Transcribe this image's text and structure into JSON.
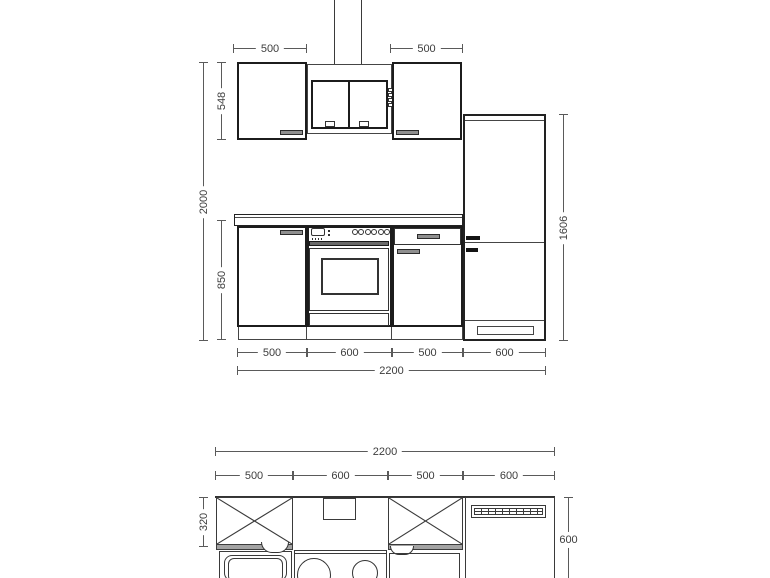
{
  "elevation": {
    "top_widths": [
      "500",
      "500"
    ],
    "wall_cabinet_height": "548",
    "total_height": "2000",
    "base_cabinet_height": "850",
    "tall_unit_height": "1606",
    "segment_widths": [
      "500",
      "600",
      "500",
      "600"
    ],
    "total_width": "2200"
  },
  "plan": {
    "total_width": "2200",
    "segment_widths": [
      "500",
      "600",
      "500",
      "600"
    ],
    "wall_cabinet_depth": "320",
    "worktop_depth": "600"
  },
  "colors": {
    "thin_line": "#454545",
    "heavy_line": "#1c1c1c",
    "dimension_line": "#5a5a5a",
    "handle_gray": "#8f8f8f",
    "handle_black": "#141414",
    "cabinet_front_gray": "#a3a3a3"
  }
}
